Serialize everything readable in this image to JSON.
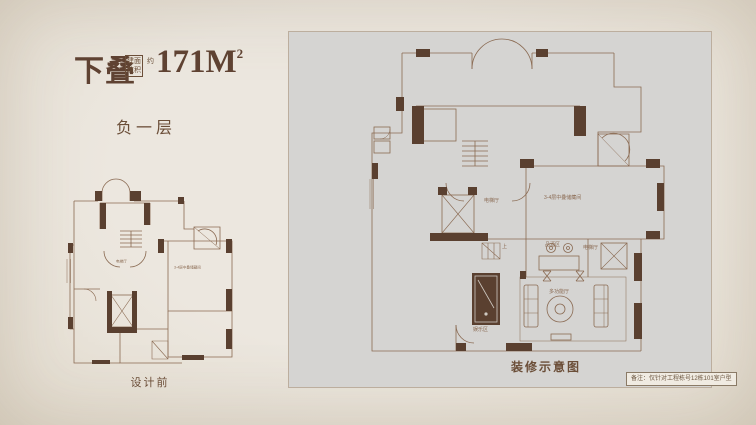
{
  "page": {
    "background": "#eae5dd",
    "panel_background": "#d5d4d2",
    "accent": "#5f4232",
    "wall_color": "#5a4030",
    "line_color": "#8a6a52"
  },
  "header": {
    "unit_type": "下叠",
    "area_box_col1": "建筑",
    "area_box_col2": "面积",
    "area_approx": "约",
    "area_value": "171M",
    "area_exponent": "2",
    "floor_label": "负一层"
  },
  "before_plan": {
    "caption": "设计前",
    "labels": {
      "elevator_hall": "电梯厅",
      "storage": "3-4层中叠储藏间"
    }
  },
  "after_plan": {
    "caption": "装修示意图",
    "labels": {
      "elevator_hall": "电梯厅",
      "storage": "3-4层中叠储藏间",
      "wine_tasting": "品酒区",
      "elevator_hall_2": "电梯厅",
      "multi_function": "多功能厅",
      "entertainment": "娱乐区",
      "stair_up": "上"
    }
  },
  "footnote": "备注：仅针对工程栋号12栋101室户型"
}
